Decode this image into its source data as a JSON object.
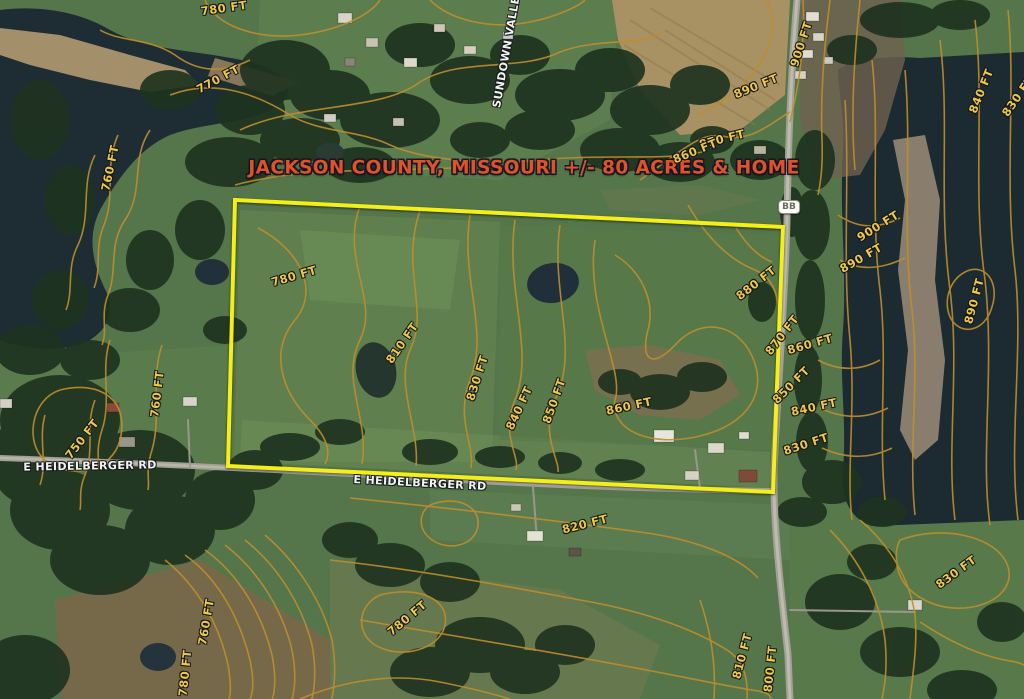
{
  "title": {
    "text": "JACKSON COUNTY, MISSOURI +/- 80 ACRES & HOME"
  },
  "colors": {
    "boundary_yellow": "#f4ef16",
    "contour_orange": "#bf8e2c",
    "title_orange": "#e1512a",
    "label_yellow": "#f2c83e",
    "road_label_white": "#f2f3ee"
  },
  "property_boundary": {
    "points": "235,200 783,227 773,492 228,466"
  },
  "route_marker": {
    "text": "BB"
  },
  "road_labels": [
    {
      "text": "E HEIDELBERGER RD",
      "x": 90,
      "y": 466,
      "rot": -1
    },
    {
      "text": "E HEIDELBERGER RD",
      "x": 420,
      "y": 483,
      "rot": 3
    },
    {
      "text": "SUNDOWN VALLEY",
      "x": 507,
      "y": 48,
      "rot": -80
    }
  ],
  "contour_labels": [
    {
      "text": "780 FT",
      "x": 224,
      "y": 8,
      "rot": -8
    },
    {
      "text": "770 FT",
      "x": 218,
      "y": 79,
      "rot": -28
    },
    {
      "text": "760 FT",
      "x": 110,
      "y": 168,
      "rot": -78
    },
    {
      "text": "890 FT",
      "x": 756,
      "y": 86,
      "rot": -22
    },
    {
      "text": "900 FT",
      "x": 801,
      "y": 44,
      "rot": -72
    },
    {
      "text": "870 FT",
      "x": 722,
      "y": 139,
      "rot": -14
    },
    {
      "text": "860 FT",
      "x": 695,
      "y": 151,
      "rot": -22
    },
    {
      "text": "840 FT",
      "x": 981,
      "y": 91,
      "rot": -68
    },
    {
      "text": "830 FT",
      "x": 1018,
      "y": 96,
      "rot": -55
    },
    {
      "text": "900 FT",
      "x": 878,
      "y": 226,
      "rot": -32
    },
    {
      "text": "890 FT",
      "x": 861,
      "y": 258,
      "rot": -30
    },
    {
      "text": "880 FT",
      "x": 756,
      "y": 283,
      "rot": -38
    },
    {
      "text": "890 FT",
      "x": 974,
      "y": 301,
      "rot": -75
    },
    {
      "text": "870 FT",
      "x": 782,
      "y": 335,
      "rot": -52
    },
    {
      "text": "860 FT",
      "x": 810,
      "y": 344,
      "rot": -16
    },
    {
      "text": "850 FT",
      "x": 791,
      "y": 385,
      "rot": -45
    },
    {
      "text": "840 FT",
      "x": 814,
      "y": 407,
      "rot": -12
    },
    {
      "text": "830 FT",
      "x": 806,
      "y": 444,
      "rot": -18
    },
    {
      "text": "780 FT",
      "x": 294,
      "y": 276,
      "rot": -16
    },
    {
      "text": "810 FT",
      "x": 402,
      "y": 343,
      "rot": -55
    },
    {
      "text": "830 FT",
      "x": 477,
      "y": 378,
      "rot": -72
    },
    {
      "text": "840 FT",
      "x": 519,
      "y": 408,
      "rot": -65
    },
    {
      "text": "850 FT",
      "x": 554,
      "y": 401,
      "rot": -70
    },
    {
      "text": "860 FT",
      "x": 629,
      "y": 406,
      "rot": -12
    },
    {
      "text": "750 FT",
      "x": 82,
      "y": 439,
      "rot": -52
    },
    {
      "text": "760 FT",
      "x": 157,
      "y": 394,
      "rot": -83
    },
    {
      "text": "820 FT",
      "x": 585,
      "y": 524,
      "rot": -14
    },
    {
      "text": "830 FT",
      "x": 956,
      "y": 572,
      "rot": -36
    },
    {
      "text": "780 FT",
      "x": 407,
      "y": 618,
      "rot": -40
    },
    {
      "text": "760 FT",
      "x": 206,
      "y": 622,
      "rot": -80
    },
    {
      "text": "780 FT",
      "x": 185,
      "y": 673,
      "rot": -84
    },
    {
      "text": "810 FT",
      "x": 742,
      "y": 656,
      "rot": -75
    },
    {
      "text": "800 FT",
      "x": 770,
      "y": 669,
      "rot": -84
    }
  ]
}
